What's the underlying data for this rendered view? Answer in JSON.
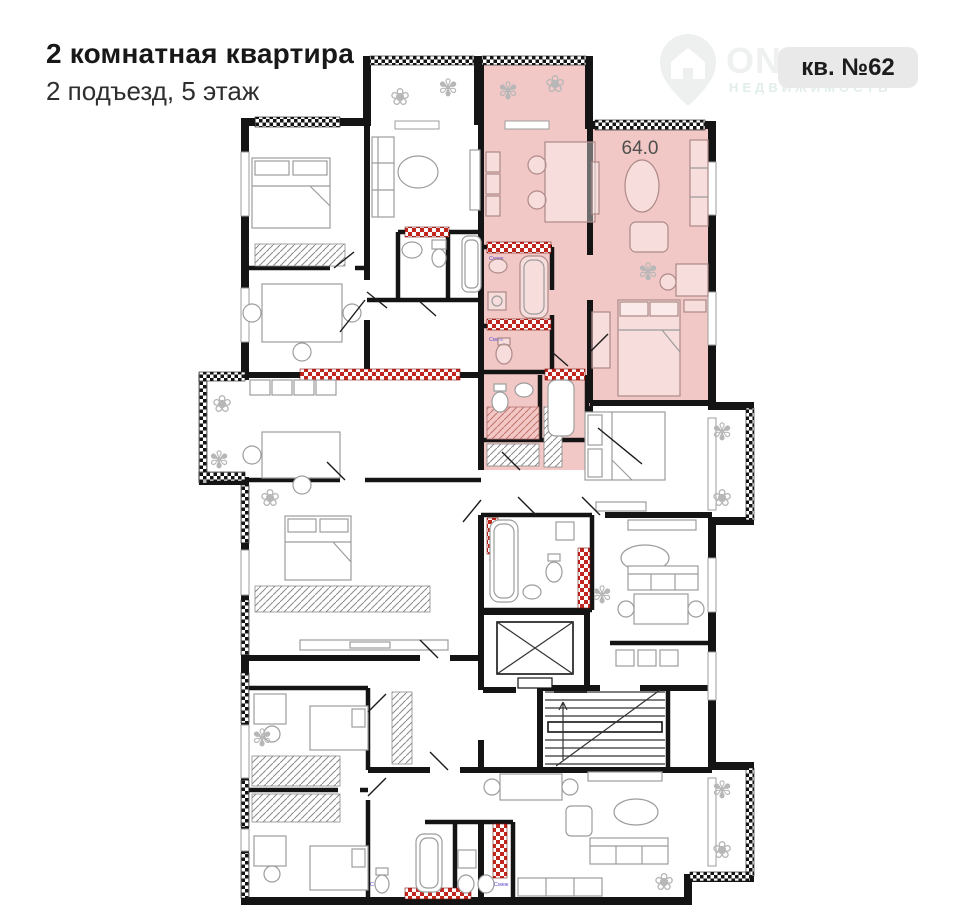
{
  "header": {
    "title": "2 комнатная квартира",
    "subtitle": "2 подъезд, 5 этаж"
  },
  "badge": {
    "label": "кв. №62"
  },
  "watermark": {
    "brand": "ONREALT",
    "tagline": "НЕДВИЖИМОСТЬ"
  },
  "plan": {
    "highlighted_area_m2": "64.0",
    "shaft_label": "Смеж"
  },
  "colors": {
    "highlight": "#f2c8c6",
    "wall": "#141414",
    "shaft_red": "#c1271e",
    "furniture": "#9c9c9c",
    "badge_bg": "#e9e9e9",
    "badge_text": "#1c1c1e",
    "title": "#181818",
    "subtitle": "#2e2e2e",
    "watermark_gray": "#eff1f1",
    "watermark_teal": "#e2eeec",
    "area_label": "#4f4f4f",
    "shaft_label_text": "#5b4bd4"
  }
}
